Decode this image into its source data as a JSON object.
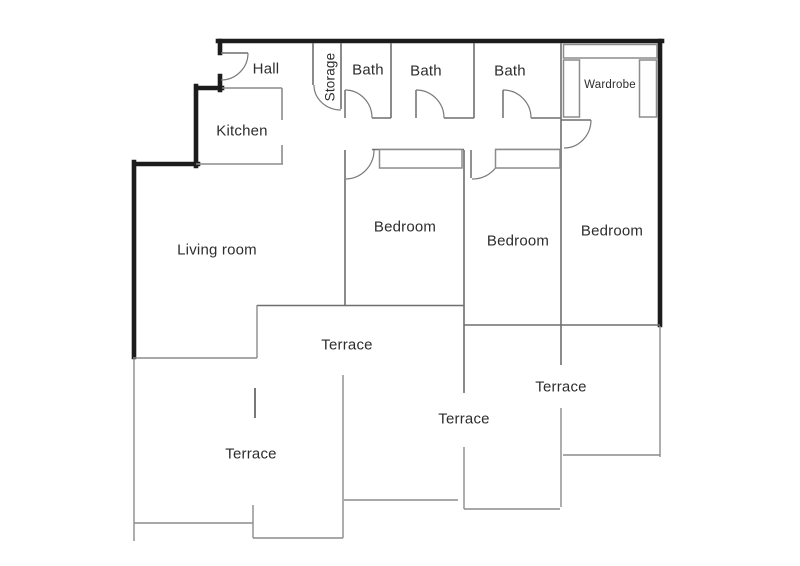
{
  "floor_plan": {
    "colors": {
      "outer_wall": "#1c1c1c",
      "interior_wall": "#6e6e6e",
      "door": "#7a7a7a",
      "furniture": "#8c8c8c",
      "terrace": "#8c8c8c",
      "divider": "#3f3f3f",
      "label_text": "#2d2d2d",
      "background": "#ffffff"
    },
    "rooms": {
      "hall": "Hall",
      "kitchen": "Kitchen",
      "storage": "Storage",
      "bath_1": "Bath",
      "bath_2": "Bath",
      "bath_3": "Bath",
      "wardrobe": "Wardrobe",
      "living_room": "Living room",
      "bedroom_1": "Bedroom",
      "bedroom_2": "Bedroom",
      "bedroom_3": "Bedroom",
      "terrace_top": "Terrace",
      "terrace_left": "Terrace",
      "terrace_middle": "Terrace",
      "terrace_right": "Terrace"
    }
  }
}
